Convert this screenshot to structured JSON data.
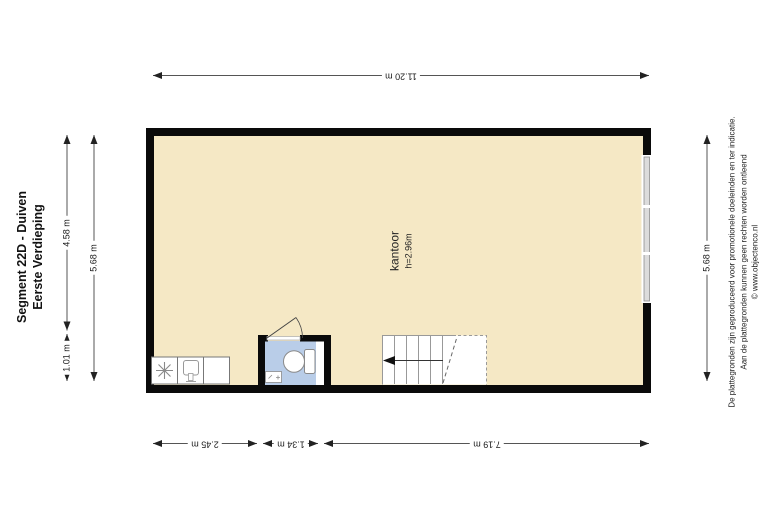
{
  "title": {
    "line1": "Segment 22D - Duiven",
    "line2": "Eerste Verdieping"
  },
  "room": {
    "label": "kantoor",
    "ceiling_height": "h=2.96m"
  },
  "dimensions": {
    "top_width": "11.20 m",
    "bottom": [
      "2.45 m",
      "1.34 m",
      "7.19 m"
    ],
    "left_segment_top": "4.58 m",
    "left_segment_bottom": "1.01 m",
    "left_total": "5.68 m",
    "right_total": "5.68 m"
  },
  "disclaimer": {
    "line1": "De plattegronden zijn geproduceerd voor promotionele doeleinden en ter indicatie.",
    "line2": "Aan de plattegronden kunnen geen rechten worden ontleend",
    "line3": "© www.objectenco.nl"
  },
  "colors": {
    "wall": "#0a0a0a",
    "room_fill": "#f5e8c5",
    "bathroom_fill": "#b9cde8",
    "dimension_line": "#555555"
  },
  "icons": {
    "refrigerator": "snowflake-icon",
    "kitchen_sink": "sink-icon",
    "bathroom_toilet": "toilet-icon",
    "bathroom_basin": "washbasin-icon",
    "door": "door-swing-icon",
    "window": "window-glazing-icon",
    "stairs_direction": "arrow-left-icon"
  }
}
